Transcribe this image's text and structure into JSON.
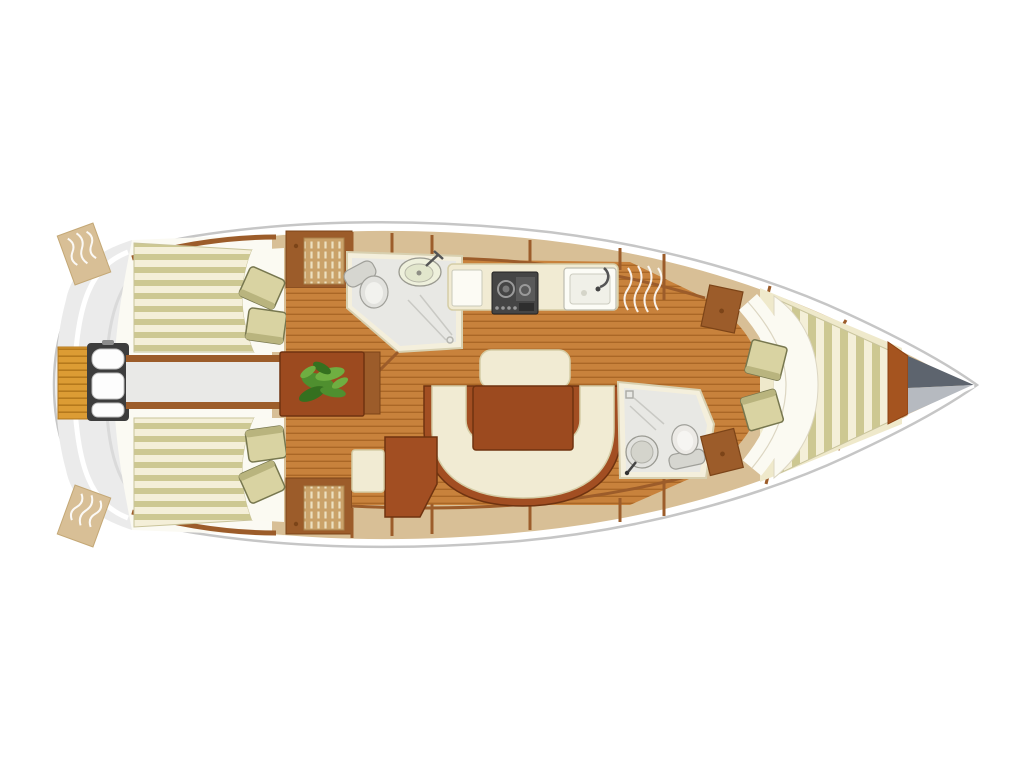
{
  "diagram": {
    "type": "sailboat-interior-floor-plan",
    "view": "top-down",
    "orientation": "bow-right-stern-left",
    "components": [
      {
        "name": "hull",
        "desc": "boat hull outline, rounded stern left, pointed bow right"
      },
      {
        "name": "swim-platform",
        "desc": "orange slatted transom platform"
      },
      {
        "name": "helm-pedestal",
        "desc": "steering pedestal with wheel at stern"
      },
      {
        "name": "cockpit-benches",
        "desc": "striped cream/olive bench seats with loose cushions"
      },
      {
        "name": "companionway",
        "desc": "walkway from helm to cabin with steps and plant table"
      },
      {
        "name": "forward-head",
        "desc": "bathroom with toilet, oval sink and shower"
      },
      {
        "name": "galley",
        "desc": "kitchen counter with stove and sink"
      },
      {
        "name": "saloon",
        "desc": "U-shaped cream settee around wooden table"
      },
      {
        "name": "nav-seat",
        "desc": "chart seat and stool"
      },
      {
        "name": "aft-head",
        "desc": "second bathroom with round sink, toilet, shower"
      },
      {
        "name": "v-berth",
        "desc": "bow cabin with striped mattress, white bedding, two cushions"
      },
      {
        "name": "anchor-locker",
        "desc": "gray bow locker at the tip"
      }
    ]
  },
  "colors": {
    "bg": "#ffffff",
    "hull-stroke": "#c6c6c6",
    "hull-fill": "#ffffff",
    "stern-gray": "#ebebeb",
    "stern-gray-dark": "#dadada",
    "cockpit-ivory": "#fbfaf3",
    "deck-tan": "#d8bf96",
    "wood-trim": "#9c5c2a",
    "wood-dark": "#7c4418",
    "floor": "#c8823c",
    "floor-line": "#aa6726",
    "platform": "#dc9c34",
    "platform-line": "#b5791c",
    "stripe-cream": "#f4efd8",
    "stripe-olive": "#cdc892",
    "cushion": "#d9d3a2",
    "cushion-edge": "#b9b47e",
    "cushion-stroke": "#77774f",
    "cream": "#f1ebd3",
    "cream-stroke": "#d5cda6",
    "table-wood": "#9c4a1f",
    "table-stroke": "#6f3310",
    "settee-base": "#a24e22",
    "wall-cream": "#f4efdc",
    "wall-stroke": "#d8d0b0",
    "bath-floor": "#e8e8e4",
    "fixture": "#e2e2de",
    "fixture-stroke": "#a0a09a",
    "stove-dark": "#454545",
    "plant-green": "#4f8f2f",
    "plant-light": "#6fae41",
    "plant-dark": "#35701f",
    "rust": "#a5541f",
    "locker-dark": "#5d646e",
    "locker-gray": "#b6bac0",
    "weave-base": "#caa269",
    "weave-line": "#ece0c0",
    "white-soft": "#fbfaf2",
    "pedestal-dark": "#3d3d3d"
  }
}
